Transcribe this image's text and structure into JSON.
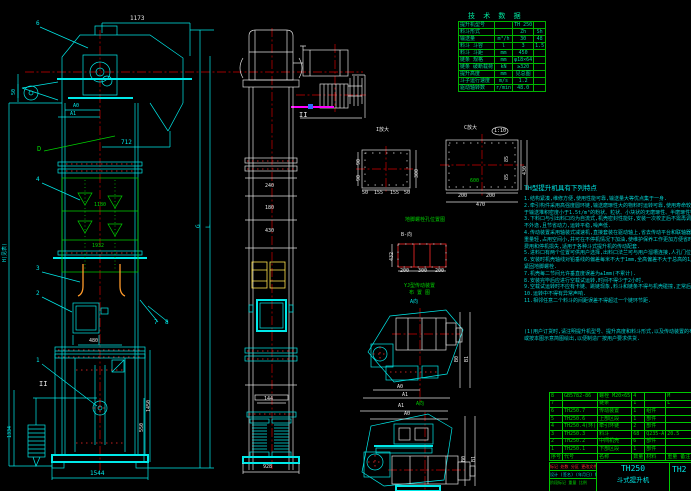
{
  "colors": {
    "background": "#000000",
    "line_cyan": "#00e8e8",
    "line_green": "#00d000",
    "line_red": "#ff2a2a",
    "line_white": "#e0e0e0",
    "bucket_orange": "#ff9a2a",
    "bucket_yellow": "#ffe34d",
    "highlight_magenta": "#ff00ff"
  },
  "tech_table": {
    "title": "技 术 数 据",
    "rows": [
      {
        "label": "提升机型号",
        "unit": "",
        "v1": "TH 250",
        "v2": ""
      },
      {
        "label": "料斗形式",
        "unit": "",
        "v1": "Zh",
        "v2": "Sh"
      },
      {
        "label": "输送量",
        "unit": "m³/h",
        "v1": "30",
        "v2": "48"
      },
      {
        "label": "料斗 斗容",
        "unit": "l",
        "v1": "3",
        "v2": "1.5"
      },
      {
        "label": "料斗 斗距",
        "unit": "mm",
        "v1": "450",
        "v2": ""
      },
      {
        "label": "链条 规格",
        "unit": "mm",
        "v1": "φ18×64",
        "v2": ""
      },
      {
        "label": "链条 破断载荷",
        "unit": "kN",
        "v1": "≥320",
        "v2": ""
      },
      {
        "label": "提升高度",
        "unit": "mm",
        "v1": "见总图",
        "v2": ""
      },
      {
        "label": "斗子运行速度",
        "unit": "m/s",
        "v1": "1.2",
        "v2": ""
      },
      {
        "label": "驱动轴转数",
        "unit": "r/min",
        "v1": "48.0",
        "v2": ""
      }
    ]
  },
  "notes": {
    "title": "TH型提升机具有下列特点",
    "lines": [
      "1.结构紧凑,维修方便,使用性能可靠,输送量大等优点集于一身.",
      "2.牵引构件采用高强度圆环链,输送磨琢性大的物料时运转可靠,使用寿命较胶带式有显著提高,适用",
      "  于输送堆积密度小于1.5t/m³的粉状、粒状、小块状的无磨琢性、半磨琢性物料.",
      "3.下料口与引出料口均为自流式,机壳密封性能好,安装一次校正后不需再调整,适于密封输送,粉尘",
      "  不外逸,且节省动力,运转平稳,噪声低.",
      "4.传动装置采用轴装式减速机,直接套装在驱动轴上,省去传动平台和联轴器,安装维修简便,结构紧凑",
      "  重量轻,占用空间小,并可在不停机情况下加油,使维护保养工作更加方便省时,易损件少,节省维修",
      "  费用和停机损失,适用于各种斗式提升机的传动配套.",
      "5.进料口有两个位置可供用户选择,出料口法兰可与用户溜槽连接,人孔门位置便于检修时进出机内部件.",
      "6.安装时机壳轴线对铅垂线的偏差每米不大于1mm,全高偏差不大于总高的1/1000,校正合格后方可",
      "  紧固地脚螺栓.",
      "7.机壳每二节间允许垂直度误差为±1mm(不累计).",
      "8.安装完毕后应进行空载试运转,时间不得少于2小时.",
      "9.空载试运转时不应有卡链、跳链现象,料斗和链条不得与机壳碰撞,正常后方可进行负载试运转.",
      "10.运转中不得有异常声响.",
      "11.相邻任意二个料斗的间距误差不得超过一个链环节距."
    ],
    "footer": [
      "(1)用户订货时,请注明提升机型号、提升高度和料斗形式,以及传动装置的布置位置(A0或A1),",
      "   或按本图示意简图绘出,以便制造厂按用户要求供货."
    ]
  },
  "parts_table": {
    "header": {
      "no": "序号",
      "code": "代号",
      "name": "名称",
      "qty": "数量",
      "mat": "材料",
      "note": "重量 备注"
    },
    "rows": [
      {
        "no": "8",
        "code": "GB5782-86",
        "name": "螺栓 M20×65",
        "qty": "4",
        "mat": "",
        "note": "M"
      },
      {
        "no": "7",
        "code": "",
        "name": "链条",
        "qty": "1",
        "mat": "",
        "note": "L"
      },
      {
        "no": "6",
        "code": "TH250.7",
        "name": "传动装置",
        "qty": "1",
        "mat": "组件",
        "note": ""
      },
      {
        "no": "5",
        "code": "TH250.6",
        "name": "上部区段",
        "qty": "1",
        "mat": "部件",
        "note": ""
      },
      {
        "no": "4",
        "code": "TH250.4(环)",
        "name": "牵引环链",
        "qty": "2",
        "mat": "部件",
        "note": ""
      },
      {
        "no": "3",
        "code": "TH250.3",
        "name": "料斗",
        "qty": "68",
        "mat": "Q235-A",
        "note": "20.5"
      },
      {
        "no": "2",
        "code": "TH250.2",
        "name": "中间机壳",
        "qty": "6",
        "mat": "部件",
        "note": ""
      },
      {
        "no": "1",
        "code": "TH250.1",
        "name": "下部区段",
        "qty": "1",
        "mat": "部件",
        "note": ""
      }
    ]
  },
  "title_block": {
    "revision_row": "标记 处数 分区 更改文件号 签字 日期",
    "sign_row": "设计 (签名) (年月日) 标准化",
    "stage_row": "阶段标记  重量  比例",
    "product_code": "TH250",
    "product_name": "斗式提升机",
    "right_partial": "TH2"
  },
  "labels": [
    {
      "name": "dim-top-width",
      "text": "1173",
      "cls": "w",
      "style": "left:130px;top:16px"
    },
    {
      "name": "callout-6",
      "text": "6",
      "cls": "",
      "style": "left:36px;top:21px"
    },
    {
      "name": "dim-50",
      "text": "50",
      "cls": "rot s5",
      "style": "left:12px;top:95px"
    },
    {
      "name": "label-a0-left",
      "text": "A0",
      "cls": "s5",
      "style": "left:73px;top:104px"
    },
    {
      "name": "label-a1-left",
      "text": "A1",
      "cls": "s5",
      "style": "left:70px;top:112px"
    },
    {
      "name": "dim-712",
      "text": "712",
      "cls": "",
      "style": "left:121px;top:140px"
    },
    {
      "name": "label-d-view",
      "text": "D",
      "cls": "g s7",
      "style": "left:37px;top:146px"
    },
    {
      "name": "callout-4",
      "text": "4",
      "cls": "",
      "style": "left:36px;top:177px"
    },
    {
      "name": "dim-1180",
      "text": "1180",
      "cls": "g s5",
      "style": "left:94px;top:203px"
    },
    {
      "name": "dim-1932",
      "text": "1932",
      "cls": "g s5",
      "style": "left:92px;top:244px"
    },
    {
      "name": "dim-total-height",
      "text": "H(见表)",
      "cls": "rot s5",
      "style": "left:3px;top:262px"
    },
    {
      "name": "dim-g",
      "text": "G",
      "cls": "rot",
      "style": "left:196px;top:228px"
    },
    {
      "name": "dim-l",
      "text": "L",
      "cls": "rot",
      "style": "left:206px;top:228px"
    },
    {
      "name": "callout-3",
      "text": "3",
      "cls": "",
      "style": "left:36px;top:266px"
    },
    {
      "name": "callout-2",
      "text": "2",
      "cls": "",
      "style": "left:36px;top:291px"
    },
    {
      "name": "callout-7",
      "text": "7",
      "cls": "",
      "style": "left:154px;top:320px"
    },
    {
      "name": "callout-8",
      "text": "8",
      "cls": "",
      "style": "left:165px;top:320px"
    },
    {
      "name": "callout-1",
      "text": "1",
      "cls": "",
      "style": "left:36px;top:358px"
    },
    {
      "name": "section-mark-II-left",
      "text": "II",
      "cls": "w s7",
      "style": "left:39px;top:381px"
    },
    {
      "name": "dim-480",
      "text": "480",
      "cls": "w s5",
      "style": "left:89px;top:339px"
    },
    {
      "name": "dim-1450",
      "text": "1450",
      "cls": "w rot s5",
      "style": "left:147px;top:412px"
    },
    {
      "name": "dim-550",
      "text": "550",
      "cls": "w rot s5",
      "style": "left:140px;top:432px"
    },
    {
      "name": "dim-1334",
      "text": "1334",
      "cls": "rot s5",
      "style": "left:8px;top:438px"
    },
    {
      "name": "dim-1544",
      "text": "1544",
      "cls": "",
      "style": "left:90px;top:471px"
    },
    {
      "name": "section-mark-II-mid",
      "text": "II",
      "cls": "w s7",
      "style": "left:299px;top:112px"
    },
    {
      "name": "dim-240",
      "text": "240",
      "cls": "w s5",
      "style": "left:265px;top:184px"
    },
    {
      "name": "dim-180",
      "text": "180",
      "cls": "w s5",
      "style": "left:265px;top:206px"
    },
    {
      "name": "dim-430",
      "text": "430",
      "cls": "w s5",
      "style": "left:265px;top:229px"
    },
    {
      "name": "dim-144",
      "text": "144",
      "cls": "w s5",
      "style": "left:264px;top:397px"
    },
    {
      "name": "dim-928",
      "text": "928",
      "cls": "w s5",
      "style": "left:263px;top:465px"
    },
    {
      "name": "label-detail-I",
      "text": "I放大",
      "cls": "w s5",
      "style": "left:376px;top:128px"
    },
    {
      "name": "dim-di-300",
      "text": "300",
      "cls": "w rot s5",
      "style": "left:415px;top:178px"
    },
    {
      "name": "dim-di-90a",
      "text": "90",
      "cls": "w rot s5",
      "style": "left:357px;top:165px"
    },
    {
      "name": "dim-di-90b",
      "text": "90",
      "cls": "w rot s5",
      "style": "left:357px;top:181px"
    },
    {
      "name": "dim-di-b1",
      "text": "50",
      "cls": "w s5",
      "style": "left:362px;top:191px"
    },
    {
      "name": "dim-di-b2",
      "text": "155",
      "cls": "w s5",
      "style": "left:374px;top:191px"
    },
    {
      "name": "dim-di-b3",
      "text": "155",
      "cls": "w s5",
      "style": "left:390px;top:191px"
    },
    {
      "name": "dim-di-b4",
      "text": "50",
      "cls": "w s5",
      "style": "left:404px;top:191px"
    },
    {
      "name": "label-detail-C",
      "text": "C放大",
      "cls": "w s5",
      "style": "left:464px;top:126px"
    },
    {
      "name": "label-detail-C-scale",
      "text": "1:10",
      "cls": "w s5",
      "style": "left:494px;top:129px"
    },
    {
      "name": "dim-dc-200a",
      "text": "200",
      "cls": "w s5",
      "style": "left:458px;top:194px"
    },
    {
      "name": "dim-dc-200b",
      "text": "200",
      "cls": "w s5",
      "style": "left:486px;top:194px"
    },
    {
      "name": "dim-dc-470",
      "text": "470",
      "cls": "w s5",
      "style": "left:476px;top:203px"
    },
    {
      "name": "dim-dc-85a",
      "text": "85",
      "cls": "w rot s5",
      "style": "left:505px;top:162px"
    },
    {
      "name": "dim-dc-85b",
      "text": "85",
      "cls": "w rot s5",
      "style": "left:505px;top:180px"
    },
    {
      "name": "dim-dc-430",
      "text": "430",
      "cls": "w rot s5",
      "style": "left:523px;top:175px"
    },
    {
      "name": "dim-dc-600",
      "text": "600",
      "cls": "g s5",
      "style": "left:470px;top:179px"
    },
    {
      "name": "label-anchor-bolt-title",
      "text": "地脚螺栓孔位置图",
      "cls": "g s5",
      "style": "left:405px;top:218px"
    },
    {
      "name": "label-b-view",
      "text": "B-向",
      "cls": "w s5",
      "style": "left:401px;top:233px"
    },
    {
      "name": "dim-b-432",
      "text": "432",
      "cls": "w rot s5",
      "style": "left:390px;top:261px"
    },
    {
      "name": "dim-b-200a",
      "text": "200",
      "cls": "w s5",
      "style": "left:400px;top:269px"
    },
    {
      "name": "dim-b-300",
      "text": "300",
      "cls": "w s5",
      "style": "left:418px;top:269px"
    },
    {
      "name": "dim-b-200b",
      "text": "200",
      "cls": "w s5",
      "style": "left:435px;top:269px"
    },
    {
      "name": "label-drive-title-1",
      "text": "YJ型传动装置",
      "cls": "g s5",
      "style": "left:404px;top:284px"
    },
    {
      "name": "label-drive-title-2",
      "text": "布 置 图",
      "cls": "g s5",
      "style": "left:409px;top:291px"
    },
    {
      "name": "label-a-view",
      "text": "A向",
      "cls": "s5",
      "style": "left:410px;top:300px"
    },
    {
      "name": "dim-v1-a0",
      "text": "A0",
      "cls": "w s5",
      "style": "left:397px;top:385px"
    },
    {
      "name": "dim-v1-a1",
      "text": "A1",
      "cls": "w s5",
      "style": "left:402px;top:393px"
    },
    {
      "name": "dim-v1-b0",
      "text": "B0",
      "cls": "w rot s5",
      "style": "left:455px;top:362px"
    },
    {
      "name": "dim-v1-b1",
      "text": "B1",
      "cls": "w rot s5",
      "style": "left:465px;top:362px"
    },
    {
      "name": "dim-v2-a1",
      "text": "A1",
      "cls": "w s5",
      "style": "left:398px;top:404px"
    },
    {
      "name": "dim-v2-a0",
      "text": "A0",
      "cls": "w s5",
      "style": "left:404px;top:412px"
    },
    {
      "name": "label-a-view-2",
      "text": "A向",
      "cls": "g s5",
      "style": "left:416px;top:402px"
    },
    {
      "name": "dim-v2-b0",
      "text": "B0",
      "cls": "w rot s5",
      "style": "left:462px;top:462px"
    },
    {
      "name": "dim-v2-b1",
      "text": "B1",
      "cls": "w rot s5",
      "style": "left:472px;top:462px"
    }
  ]
}
